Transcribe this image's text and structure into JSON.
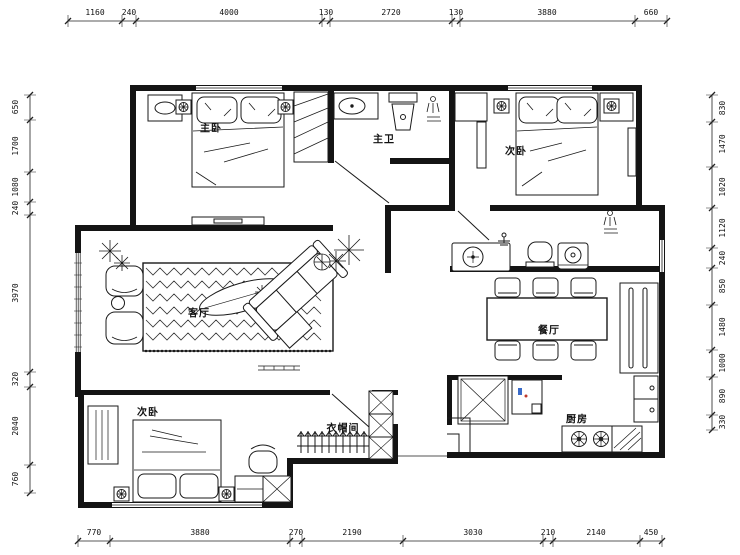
{
  "plan": {
    "rooms": {
      "master_bedroom": "主卧",
      "master_bath": "主卫",
      "bedroom2": "次卧",
      "living": "客厅",
      "dining": "餐厅",
      "kitchen": "厨房",
      "bedroom3": "次卧",
      "cloakroom": "衣帽间"
    },
    "dimensions": {
      "top": [
        "1160",
        "240",
        "4000",
        "130",
        "2720",
        "130",
        "3880",
        "660"
      ],
      "bottom": [
        "770",
        "3880",
        "270",
        "2190",
        "3030",
        "210",
        "2140",
        "450"
      ],
      "left": [
        "650",
        "1700",
        "1080",
        "240",
        "3970",
        "320",
        "2040",
        "760"
      ],
      "right": [
        "830",
        "1470",
        "1020",
        "1120",
        "240",
        "850",
        "1480",
        "1000",
        "890",
        "330"
      ]
    }
  }
}
